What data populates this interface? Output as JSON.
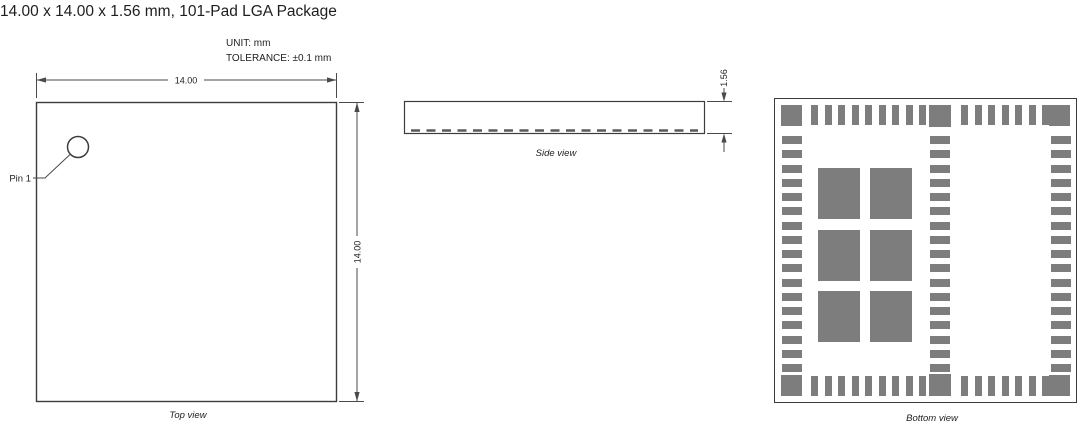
{
  "title": "14.00 x 14.00 x 1.56 mm, 101-Pad LGA Package",
  "notes": {
    "unit": "UNIT: mm",
    "tolerance": "TOLERANCE: ±0.1 mm"
  },
  "colors": {
    "line": "#3c3c3c",
    "dim_line": "#4a4a4a",
    "pad": "#7d7d7d",
    "text": "#1e1e1e"
  },
  "top_view": {
    "label": "Top view",
    "pin1_label": "Pin 1",
    "width_dim": "14.00",
    "height_dim": "14.00"
  },
  "side_view": {
    "label": "Side view",
    "thickness_dim": "1.56"
  },
  "bottom_view": {
    "label": "Bottom view",
    "pin1_label": "Pin 1",
    "layout": {
      "x": 774,
      "y": 98,
      "w": 303,
      "h": 305,
      "inset": 6,
      "corner_size": 21,
      "center_pad_x": 154,
      "center_pad_size": 22,
      "edge_bar_w": 7,
      "edge_bar_h": 20,
      "edge_bar_groups": [
        {
          "start": 36,
          "pitch": 13.5,
          "count": 9
        },
        {
          "start": 186,
          "pitch": 13.5,
          "count": 7
        }
      ],
      "column_xs": [
        7,
        155,
        276
      ],
      "column_first_y": 37,
      "column_pitch": 14.25,
      "column_count": 17,
      "column_bar_w": 20,
      "column_bar_h": 8,
      "big_pad_xs": [
        43,
        95
      ],
      "big_pad_ys": [
        69,
        131,
        192
      ],
      "big_pad_w": 42,
      "big_pad_h": 51
    }
  }
}
